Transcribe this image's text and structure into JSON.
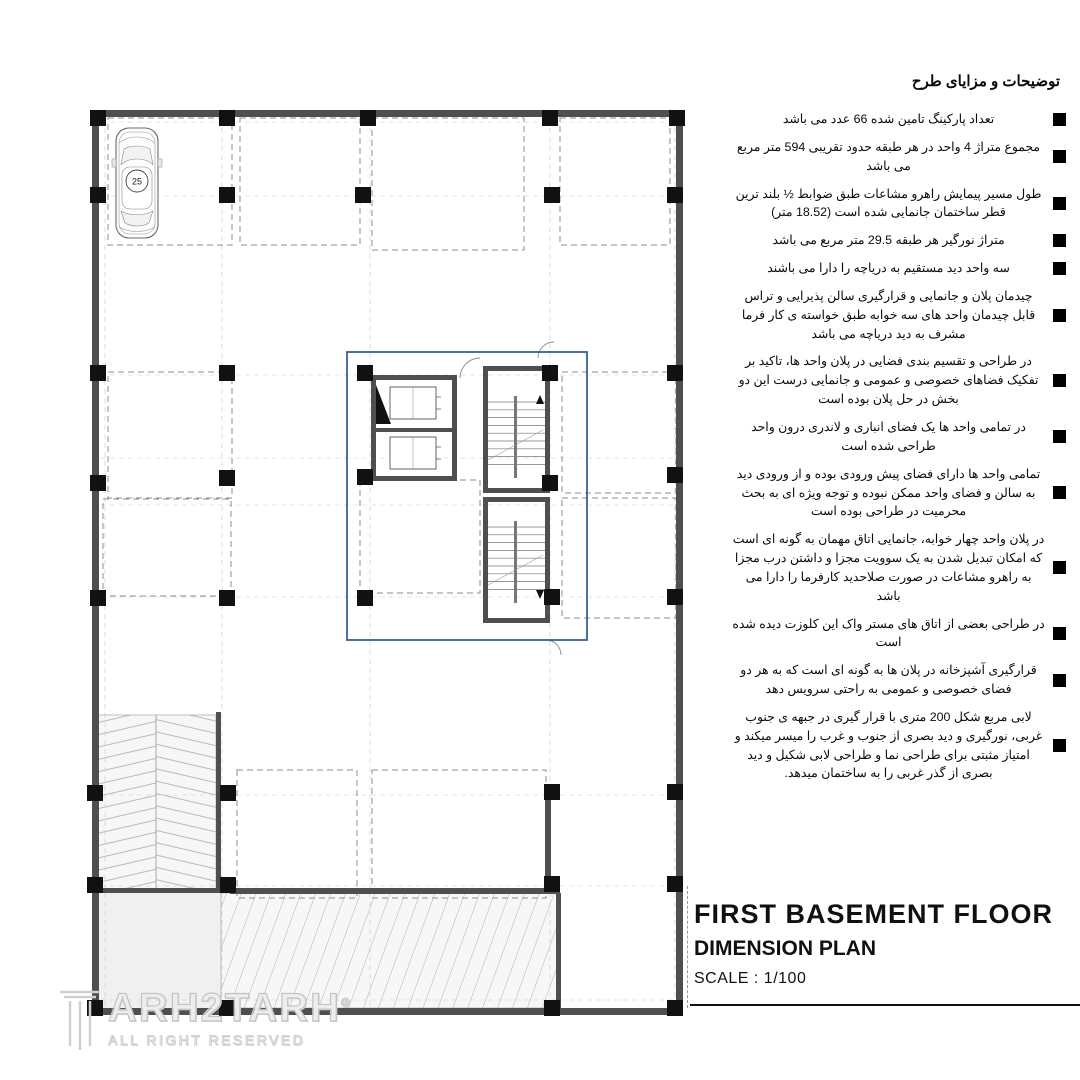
{
  "notes": {
    "title": "توضیحات و مزایای طرح",
    "items": [
      "تعداد پارکینگ تامین شده 66 عدد می باشد",
      "مجموع متراژ 4 واحد در هر طبقه حدود تقریبی 594 متر مربع می باشد",
      "طول مسیر پیمایش راهرو مشاعات طبق ضوابط ½ بلند ترین قطر ساختمان جانمایی شده است (18.52 متر)",
      "متراژ نورگیر هر طبقه 29.5 متر مربع می باشد",
      "سه واحد دید مستقیم به دریاچه را دارا می باشند",
      "چیدمان پلان و جانمایی و قرارگیری سالن پذیرایی و تراس قابل چیدمان واحد های سه خوابه طبق خواسته ی کار فرما مشرف به دید دریاچه می باشد",
      "در طراحی و تقسیم بندی فضایی در پلان واحد ها، تاکید بر تفکیک فضاهای خصوصی و عمومی و جانمایی درست این دو بخش در حل پلان بوده است",
      "در تمامی واحد ها یک فضای انباری و لاندری درون واحد طراحی شده است",
      "تمامی واحد ها دارای فضای پیش ورودی بوده و از ورودی دید به سالن و فضای واحد ممکن نبوده و توجه ویژه ای به بحث محرمیت در طراحی بوده است",
      "در پلان واحد چهار خوابه، جانمایی اتاق مهمان به گونه ای است که امکان تبدیل شدن به یک سوویت مجزا و داشتن درب مجزا به راهرو مشاعات در صورت صلاحدید کارفرما را دارا می باشد",
      "در طراحی بعضی از اتاق های مستر واک این کلوزت دیده شده است",
      "قرارگیری آشپزخانه در پلان ها به گونه ای است که به هر دو فضای خصوصی و عمومی به راحتی سرویس دهد",
      "لابی مربع شکل 200 متری با قرار گیری در جبهه ی جنوب غربی، نورگیری و دید بصری از جنوب و غرب را میسر میکند و امتیاز مثبتی برای طراحی نما و طراحی لابی شکیل و دید بصری از گذر غربی را به ساختمان میدهد."
    ]
  },
  "title_block": {
    "line1": "FIRST BASEMENT FLOOR",
    "line2": "DIMENSION PLAN",
    "scale": "SCALE : 1/100"
  },
  "compass": {
    "n": "N",
    "e": "E",
    "s": "S",
    "w": "W"
  },
  "watermark": {
    "brand": "ARH2TARH",
    "registered": "®",
    "sub": "ALL RIGHT RESERVED"
  },
  "grid": {
    "top": [
      {
        "label": "A",
        "x": 105
      },
      {
        "label": "B",
        "x": 222
      },
      {
        "label": "C",
        "x": 370
      },
      {
        "label": "D",
        "x": 550
      },
      {
        "label": "E",
        "x": 675
      }
    ],
    "left": [
      {
        "label": "1",
        "y": 122
      },
      {
        "label": "2",
        "y": 196
      },
      {
        "label": "3",
        "y": 375
      },
      {
        "label": "4",
        "y": 458,
        "ty": 480
      },
      {
        "label": "5",
        "y": 505,
        "ty": 487
      },
      {
        "label": "6",
        "y": 597
      },
      {
        "label": "7",
        "y": 795
      },
      {
        "label": "8",
        "y": 886
      },
      {
        "label": "9",
        "y": 1000
      }
    ],
    "top_overall": {
      "t": "22.98 m",
      "x": 437
    },
    "top_segments": [
      {
        "t": "4.95 m",
        "x": 163
      },
      {
        "t": "5.57 m",
        "x": 296
      },
      {
        "t": "7.52 m",
        "x": 460
      },
      {
        "t": "4.95 m",
        "x": 612
      },
      {
        "t": "0.16 m",
        "x": 684,
        "r": -90
      }
    ],
    "left_overall": {
      "t": "36.1 m",
      "y": 545
    },
    "left_segments": [
      {
        "t": "3.05 m",
        "y": 159
      },
      {
        "t": "7.26 m",
        "y": 285
      },
      {
        "t": "4.02 m",
        "y": 417
      },
      {
        "t": "5.02 m",
        "y": 551
      },
      {
        "t": "7.96 m",
        "y": 696
      },
      {
        "t": "3.63 m",
        "y": 840
      },
      {
        "t": "5.16 m",
        "y": 943
      }
    ]
  },
  "plan": {
    "cars": [
      {
        "n": "25",
        "x": 137,
        "y": 183
      },
      {
        "n": "26",
        "x": 197,
        "y": 183
      },
      {
        "n": "27",
        "x": 269,
        "y": 183
      },
      {
        "n": "28",
        "x": 329,
        "y": 183
      },
      {
        "n": "29",
        "x": 400,
        "y": 186
      },
      {
        "n": "30",
        "x": 459,
        "y": 186
      },
      {
        "n": "31",
        "x": 518,
        "y": 186
      },
      {
        "n": "32",
        "x": 588,
        "y": 183
      },
      {
        "n": "33",
        "x": 642,
        "y": 183
      },
      {
        "n": "23",
        "x": 137,
        "y": 437
      },
      {
        "n": "24",
        "x": 200,
        "y": 437
      },
      {
        "n": "20",
        "x": 160,
        "y": 525,
        "o": "hr"
      },
      {
        "n": "22",
        "x": 424,
        "y": 510,
        "o": "hl"
      },
      {
        "n": "21",
        "x": 424,
        "y": 567,
        "o": "hl"
      },
      {
        "n": "35",
        "x": 590,
        "y": 437
      },
      {
        "n": "34",
        "x": 648,
        "y": 437
      },
      {
        "n": "36",
        "x": 590,
        "y": 548
      },
      {
        "n": "37",
        "x": 648,
        "y": 548
      },
      {
        "n": "15",
        "x": 266,
        "y": 834
      },
      {
        "n": "16",
        "x": 326,
        "y": 834
      },
      {
        "n": "17",
        "x": 400,
        "y": 834
      },
      {
        "n": "18",
        "x": 460,
        "y": 834
      },
      {
        "n": "19",
        "x": 520,
        "y": 834
      }
    ],
    "levels": [
      {
        "t": "-3.6",
        "x": 424,
        "y": 330
      },
      {
        "t": "-3.6",
        "x": 122,
        "y": 686
      },
      {
        "t": "-3.6",
        "x": 516,
        "y": 656
      },
      {
        "t": "-3.6",
        "x": 618,
        "y": 962
      },
      {
        "t": "-2.46",
        "x": 99,
        "y": 977
      }
    ],
    "ramp_left": {
      "slope": "S: 16%",
      "length": "L: 6.50"
    },
    "ramp_bottom": {
      "slope": "S: 10%",
      "length": "L:13.70"
    },
    "dims": [
      {
        "t": "4.79 m",
        "x": 155,
        "y": 240
      },
      {
        "t": "4.5 m",
        "x": 250,
        "y": 270,
        "fs": 6
      },
      {
        "t": "5.08 m",
        "x": 296,
        "y": 197,
        "fs": 6
      },
      {
        "t": "7.07 m",
        "x": 450,
        "y": 212
      },
      {
        "t": "4.5 m",
        "x": 600,
        "y": 197,
        "fs": 6
      },
      {
        "t": "2.04 m",
        "x": 663,
        "y": 222,
        "r": -90,
        "fs": 5
      },
      {
        "t": "4.59 m",
        "x": 163,
        "y": 370
      },
      {
        "t": "5.06 m",
        "x": 292,
        "y": 376,
        "fs": 6
      },
      {
        "t": "4.1 m",
        "x": 163,
        "y": 422,
        "fs": 6
      },
      {
        "t": "4.95 m",
        "x": 158,
        "y": 459,
        "fs": 6
      },
      {
        "t": "5.5 m",
        "x": 298,
        "y": 442
      },
      {
        "t": "5 m",
        "x": 297,
        "y": 480
      },
      {
        "t": "5 m",
        "x": 295,
        "y": 592
      },
      {
        "t": "11.48 m",
        "x": 344,
        "y": 497,
        "r": -90,
        "fs": 6
      },
      {
        "t": "4.59 m",
        "x": 607,
        "y": 367
      },
      {
        "t": "5.04 m",
        "x": 626,
        "y": 413,
        "fs": 6
      },
      {
        "t": "4.58 m",
        "x": 623,
        "y": 480,
        "fs": 6
      },
      {
        "t": "5.04 m",
        "x": 626,
        "y": 517,
        "fs": 6
      },
      {
        "t": "4.58 m",
        "x": 623,
        "y": 601,
        "fs": 6
      },
      {
        "t": "7.50 m",
        "x": 417,
        "y": 356,
        "fs": 6
      },
      {
        "t": "3.6 m",
        "x": 520,
        "y": 358,
        "fs": 6
      },
      {
        "t": "4.53 m",
        "x": 427,
        "y": 374,
        "fs": 6
      },
      {
        "t": "2 m",
        "x": 412,
        "y": 412,
        "fs": 6
      },
      {
        "t": "1.5 m",
        "x": 464,
        "y": 427,
        "fs": 6
      },
      {
        "t": "2.01 m",
        "x": 406,
        "y": 432,
        "fs": 6
      },
      {
        "t": "1.8 m",
        "x": 384,
        "y": 440,
        "r": -90,
        "fs": 5
      },
      {
        "t": "2.4 m",
        "x": 516,
        "y": 485,
        "fs": 6
      },
      {
        "t": "5 m",
        "x": 418,
        "y": 537,
        "fs": 6
      },
      {
        "t": "4.67 m",
        "x": 474,
        "y": 537,
        "r": -90,
        "fs": 5
      },
      {
        "t": "5.03 m",
        "x": 480,
        "y": 549,
        "r": -90,
        "fs": 5
      },
      {
        "t": "2.4 m",
        "x": 517,
        "y": 609,
        "fs": 6
      },
      {
        "t": "10 m",
        "x": 358,
        "y": 612,
        "fs": 6
      },
      {
        "t": "13.52 m",
        "x": 287,
        "y": 615
      },
      {
        "t": "7.39 m",
        "x": 443,
        "y": 630
      },
      {
        "t": "5.53 m",
        "x": 214,
        "y": 667,
        "r": -90,
        "fs": 6
      },
      {
        "t": "6.40 m",
        "x": 364,
        "y": 688,
        "r": -90,
        "fs": 6
      },
      {
        "t": "5.76 m",
        "x": 503,
        "y": 688,
        "r": -90,
        "fs": 6
      },
      {
        "t": "5 m",
        "x": 157,
        "y": 724
      },
      {
        "t": "5.08 m",
        "x": 260,
        "y": 795,
        "fs": 6
      },
      {
        "t": "7.06 m",
        "x": 458,
        "y": 790,
        "fs": 6
      },
      {
        "t": "5.24 m",
        "x": 607,
        "y": 762
      },
      {
        "t": "5 m",
        "x": 617,
        "y": 822
      },
      {
        "t": "4.37 m",
        "x": 612,
        "y": 879
      },
      {
        "t": "5 m",
        "x": 614,
        "y": 905
      },
      {
        "t": "5 m",
        "x": 157,
        "y": 905
      },
      {
        "t": "23.57 m",
        "x": 378,
        "y": 992,
        "fs": 6
      },
      {
        "t": "4.33 m",
        "x": 551,
        "y": 962,
        "r": -90,
        "fs": 5
      }
    ]
  }
}
